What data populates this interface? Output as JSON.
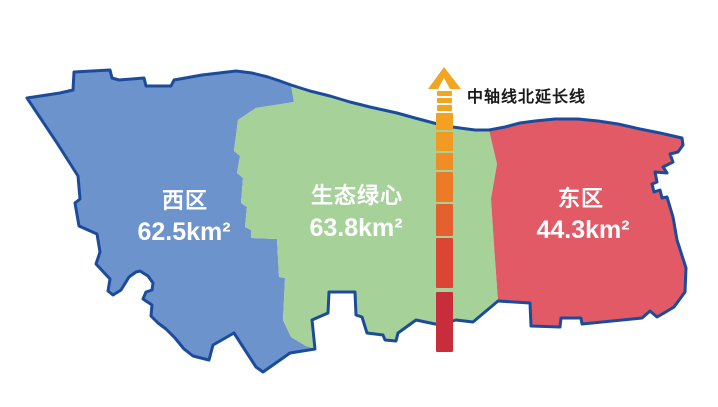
{
  "map": {
    "background_color": "#FFFFFF",
    "outline_color": "#1B4C9C",
    "label_text_color": "#FFFFFF",
    "regions": {
      "west": {
        "name": "西区",
        "area": "62.5km²",
        "fill": "#6C93CB"
      },
      "center": {
        "name": "生态绿心",
        "area": "63.8km²",
        "fill": "#A6D29A"
      },
      "east": {
        "name": "东区",
        "area": "44.3km²",
        "fill": "#E15A66"
      }
    },
    "axis": {
      "label": "中轴线北延长线",
      "label_color": "#1A1A1A",
      "arrow_color": "#F2A51F",
      "dash_colors": [
        "#F4A71E",
        "#F4A51F",
        "#F3A320"
      ],
      "segment_colors": [
        "#F3A122",
        "#F29B24",
        "#F08D26",
        "#EC7B28",
        "#E4602E",
        "#DB4533",
        "#C82D3B"
      ]
    }
  }
}
